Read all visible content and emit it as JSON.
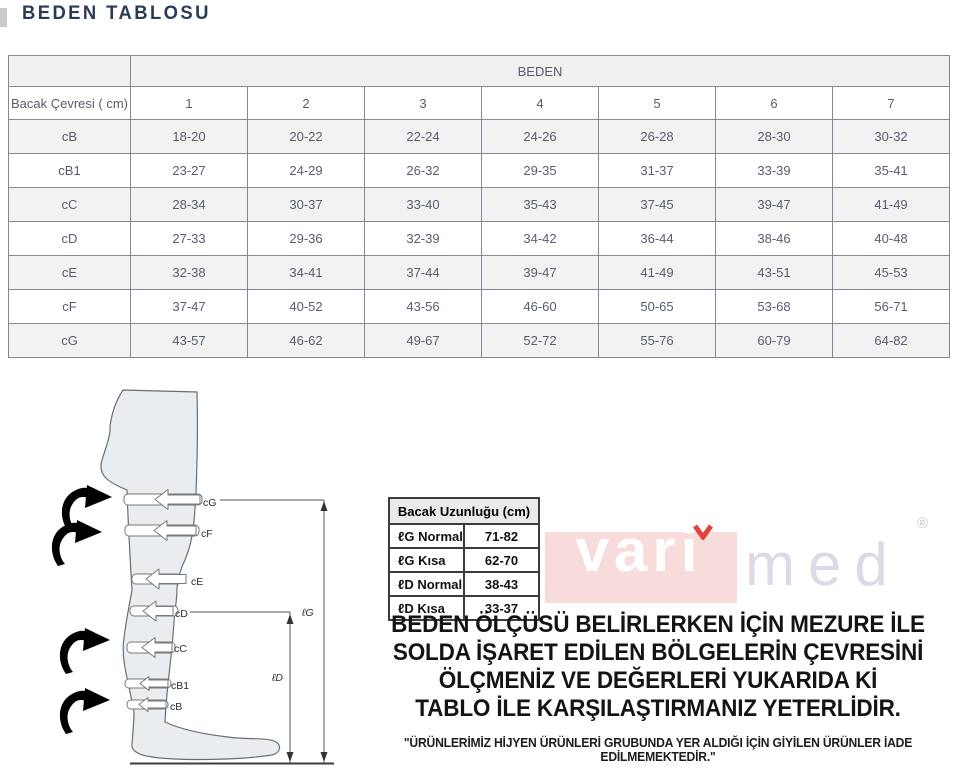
{
  "title": "BEDEN TABLOSU",
  "size_table": {
    "group_header": "BEDEN",
    "corner_label": "Bacak Çevresi ( cm)",
    "sizes": [
      "1",
      "2",
      "3",
      "4",
      "5",
      "6",
      "7"
    ],
    "rows": [
      {
        "label": "cB",
        "values": [
          "18-20",
          "20-22",
          "22-24",
          "24-26",
          "26-28",
          "28-30",
          "30-32"
        ]
      },
      {
        "label": "cB1",
        "values": [
          "23-27",
          "24-29",
          "26-32",
          "29-35",
          "31-37",
          "33-39",
          "35-41"
        ]
      },
      {
        "label": "cC",
        "values": [
          "28-34",
          "30-37",
          "33-40",
          "35-43",
          "37-45",
          "39-47",
          "41-49"
        ]
      },
      {
        "label": "cD",
        "values": [
          "27-33",
          "29-36",
          "32-39",
          "34-42",
          "36-44",
          "38-46",
          "40-48"
        ]
      },
      {
        "label": "cE",
        "values": [
          "32-38",
          "34-41",
          "37-44",
          "39-47",
          "41-49",
          "43-51",
          "45-53"
        ]
      },
      {
        "label": "cF",
        "values": [
          "37-47",
          "40-52",
          "43-56",
          "46-60",
          "50-65",
          "53-68",
          "56-71"
        ]
      },
      {
        "label": "cG",
        "values": [
          "43-57",
          "46-62",
          "49-67",
          "52-72",
          "55-76",
          "60-79",
          "64-82"
        ]
      }
    ]
  },
  "length_table": {
    "header": "Bacak Uzunluğu (cm)",
    "rows": [
      {
        "label": "ℓG Normal",
        "value": "71-82"
      },
      {
        "label": "ℓG Kısa",
        "value": "62-70"
      },
      {
        "label": "ℓD Normal",
        "value": "38-43"
      },
      {
        "label": "ℓD Kısa",
        "value": "33-37"
      }
    ]
  },
  "diagram": {
    "bands": [
      {
        "label": "cG"
      },
      {
        "label": "cF"
      },
      {
        "label": "cE"
      },
      {
        "label": "cD"
      },
      {
        "label": "cC"
      },
      {
        "label": "cB1"
      },
      {
        "label": "cB"
      }
    ],
    "measure_labels": {
      "lg": "ℓG",
      "ld": "ℓD"
    }
  },
  "brand": {
    "part1": "vari",
    "part2": "med",
    "registered": "®"
  },
  "colors": {
    "title": "#2c3a55",
    "table_text": "#565d6d",
    "stripe": "#f2f2f3",
    "brand_pink": "#f8dcdc",
    "brand_red": "#e2423d",
    "brand_gray": "#dcdae6"
  },
  "instructions": {
    "lines": [
      "BEDEN ÖLÇÜSÜ BELİRLERKEN İÇİN MEZURE İLE",
      "SOLDA İŞARET EDİLEN BÖLGELERİN ÇEVRESİNİ",
      "ÖLÇMENİZ VE DEĞERLERİ YUKARIDA Kİ",
      "TABLO İLE KARŞILAŞTIRMANIZ YETERLİDİR."
    ],
    "footnote": "\"ÜRÜNLERİMİZ HİJYEN ÜRÜNLERİ GRUBUNDA YER ALDIĞI İÇİN GİYİLEN ÜRÜNLER İADE EDİLMEMEKTEDİR.\""
  }
}
